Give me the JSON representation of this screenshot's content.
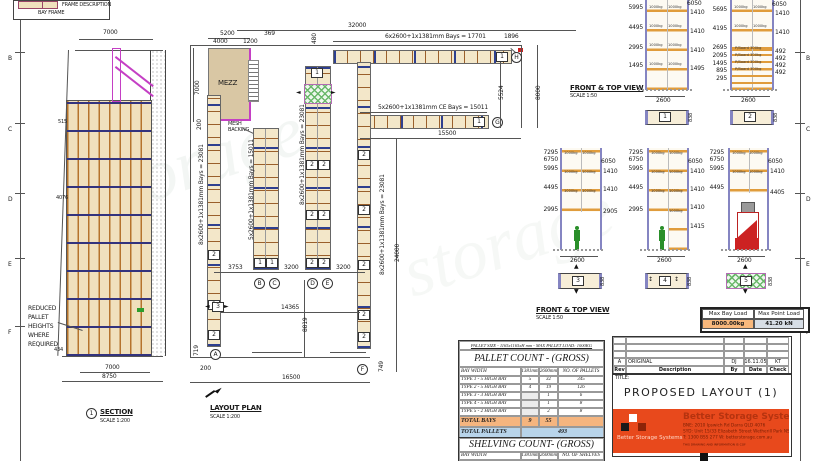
{
  "watermark": "storage",
  "icons": {
    "arrow_left": "◄",
    "arrow_right": "►",
    "arrow_updown": "↕",
    "arrow_up": "▲",
    "arrow_down": "▼"
  },
  "border": {
    "letters": [
      "B",
      "C",
      "D",
      "E",
      "F"
    ]
  },
  "legend": {
    "frame_description": "FRAME DESCRIPTION",
    "bay_frame": "BAY FRAME"
  },
  "section": {
    "title": "SECTION",
    "scale": "SCALE 1:200",
    "marker": "1",
    "note1": "REDUCED",
    "note2": "PALLET",
    "note3": "HEIGHTS",
    "note4": "WHERE",
    "note5": "REQUIRED",
    "dim_top": "7000",
    "dim_inner": "7000",
    "dim_outer": "8750",
    "dim_a": "515",
    "dim_b": "4076",
    "dim_c": "434"
  },
  "plan": {
    "title": "LAYOUT PLAN",
    "scale": "SCALE 1:200",
    "mezz": "MEZZ",
    "mesh1": "MESH",
    "mesh2": "BACKING",
    "d32000": "32000",
    "d5200": "5200",
    "d4000": "4000",
    "d1200": "1200",
    "d369": "369",
    "d480": "480",
    "bays17701": "6x2600+1x1381mm Bays = 17701",
    "d1896": "1896",
    "d5524": "5524",
    "d8000": "8000",
    "bays15011ce": "5x2600+1x1381mm CE Bays = 15011",
    "d15500": "15500",
    "d24000": "24000",
    "bays23081": "8x2600+1x1381mm Bays = 23081",
    "bays15011": "5x2600+1x1381mm Bays = 15011",
    "d7000": "7000",
    "d200a": "200",
    "d200b": "200",
    "d3753": "3753",
    "d3200a": "3200",
    "d3200b": "3200",
    "d14365": "14365",
    "d8819": "8819",
    "d16500": "16500",
    "d719": "719",
    "d749": "749",
    "n1": "1",
    "n2": "2",
    "n3": "3",
    "ca": "A",
    "cb": "B",
    "cc": "C",
    "cd": "D",
    "ce": "E",
    "cf": "F",
    "cg": "G",
    "ch": "H"
  },
  "views": {
    "label": "FRONT & TOP VIEW",
    "scale": "SCALE 1:50",
    "load": "1000kg",
    "pboard": "P/Board 300kg",
    "width": "2600",
    "depth": "838",
    "e1": {
      "num": "1",
      "left": [
        "5995",
        "4495",
        "2995",
        "1495"
      ],
      "right": [
        "6050",
        "1410",
        "1410",
        "1410",
        "1495"
      ]
    },
    "e2": {
      "num": "2",
      "left": [
        "5695",
        "4195",
        "2695",
        "2095",
        "1495",
        "895",
        "295"
      ],
      "right": [
        "6050",
        "1410",
        "1410",
        "492",
        "492",
        "492",
        "492"
      ]
    },
    "e3": {
      "num": "3",
      "left": [
        "7295",
        "6750",
        "5995",
        "4495",
        "2995"
      ],
      "right": [
        "6050",
        "1410",
        "1410",
        "2905"
      ]
    },
    "e4": {
      "num": "4",
      "left": [
        "7295",
        "6750",
        "5995",
        "4495",
        "2995"
      ],
      "right": [
        "6050",
        "1410",
        "1410",
        "1410",
        "1415"
      ]
    },
    "e5": {
      "num": "5",
      "left": [
        "7295",
        "6750",
        "5995",
        "4495"
      ],
      "right": [
        "6050",
        "1410",
        "4405"
      ]
    }
  },
  "load_box": {
    "bay_label": "Max Bay Load",
    "bay_value": "8000.00kg",
    "point_label": "Max Point Load",
    "point_value": "41.20 kN"
  },
  "pallet_table": {
    "note": "PALLET SIZE - 1165x1165xH mm - MAX PALLET LOAD: 1000KG",
    "title": "PALLET COUNT - (GROSS)",
    "headers": [
      "BAY WIDTH",
      "1381mm",
      "2600mm",
      "NO. OF PALLETS"
    ],
    "rows": [
      [
        "TYPE 1 - 5 HIGH BAY",
        "5",
        "32",
        "345"
      ],
      [
        "TYPE 2 - 5 HIGH BAY",
        "4",
        "19",
        "126"
      ],
      [
        "TYPE 3 - 3 HIGH BAY",
        "",
        "1",
        "6"
      ],
      [
        "TYPE 4 - 5 HIGH BAY",
        "",
        "1",
        "8"
      ],
      [
        "TYPE 5 - 2 HIGH BAY",
        "",
        "2",
        "8"
      ]
    ],
    "total_bays": [
      "TOTAL BAYS",
      "9",
      "55"
    ],
    "total_pallets_label": "TOTAL PALLETS",
    "total_pallets": "493"
  },
  "shelving_table": {
    "title": "SHELVING COUNT- (GROSS)",
    "headers": [
      "BAY WIDTH",
      "1381mm",
      "2600mm",
      "NO. OF SHELVES"
    ],
    "row": [
      "TYPE 2 - 4 HIGH BAY",
      "4",
      "19",
      "235.70L/m"
    ]
  },
  "title_block": {
    "rev": [
      "A",
      "ORIGINAL",
      "DJ",
      "16.11.05",
      "KT"
    ],
    "cols": [
      "Rev",
      "Description",
      "By",
      "Date",
      "Check"
    ],
    "title_label": "TITLE:",
    "title": "PROPOSED LAYOUT (1)",
    "brand": "Better Storage Systems",
    "brand_small": "Better Storage Systems",
    "addr1": "BNE: 2010 Ipswich Rd Darra QLD 4076",
    "addr2": "SYD: Unit 15/33 Elizabeth Street Wetherill Park NSW 2164",
    "addr3": "T: 1300 BSS 277   W: betterstorage.com.au",
    "disclaimer": "THIS DRAWING AND INFORMATION IS COPYRIGHT AND CONFIDENTIAL AND MUST NOT BE COPIED OR REPRODUCED WITHOUT PERMISSION"
  }
}
